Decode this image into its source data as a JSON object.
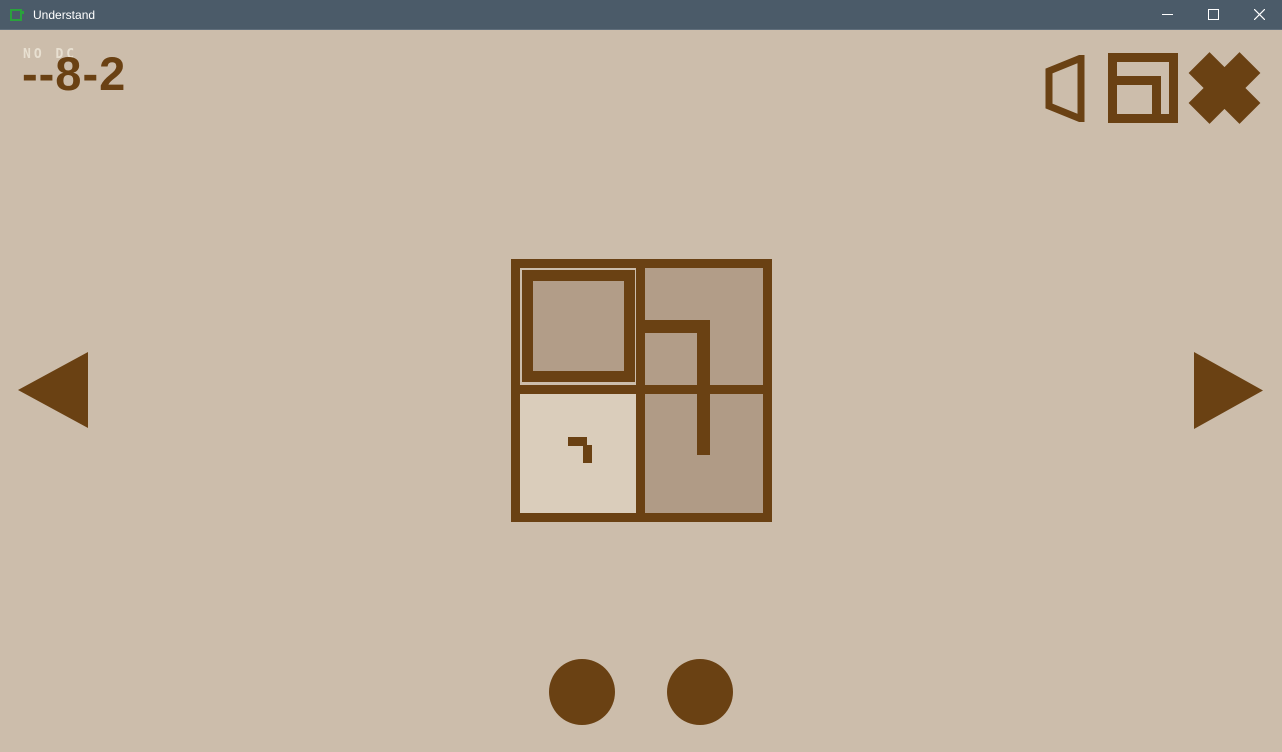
{
  "window": {
    "title": "Understand",
    "controls": [
      {
        "name": "minimize",
        "glyph": "—"
      },
      {
        "name": "maximize",
        "glyph": "▢"
      },
      {
        "name": "close",
        "glyph": "✕"
      }
    ]
  },
  "hud": {
    "level_tag": "NO DC",
    "level_name": "--8-2"
  },
  "toolbar": {
    "icons": [
      "speaker-icon",
      "nested-square-icon",
      "cross-icon"
    ]
  },
  "navigation": {
    "prev": "left-triangle-arrow",
    "next": "right-triangle-arrow"
  },
  "puzzle": {
    "grid": {
      "rows": 2,
      "cols": 2
    },
    "cells": [
      {
        "pos": "top-left",
        "feature": "inset-square-outline"
      },
      {
        "pos": "top-right",
        "feature": "drawn-path-corner"
      },
      {
        "pos": "bottom-left",
        "feature": "small-corner-glyph"
      },
      {
        "pos": "bottom-right",
        "feature": "drawn-path-end"
      }
    ],
    "path": "starts-at-center-divider, right, then down into bottom-right cell"
  },
  "pager": {
    "dot_count": 2
  },
  "colors": {
    "titlebar_bg": "#4b5b69",
    "titlebar_text": "#ffffff",
    "app_icon_green": "#2aa23c",
    "bg": "#ccbdab",
    "brown": "#6a4113",
    "cell_tan": "#b29d88",
    "cell_tan2": "#b09b86",
    "cell_cream": "#dacdbb",
    "tag_text": "#e8e0d1"
  }
}
